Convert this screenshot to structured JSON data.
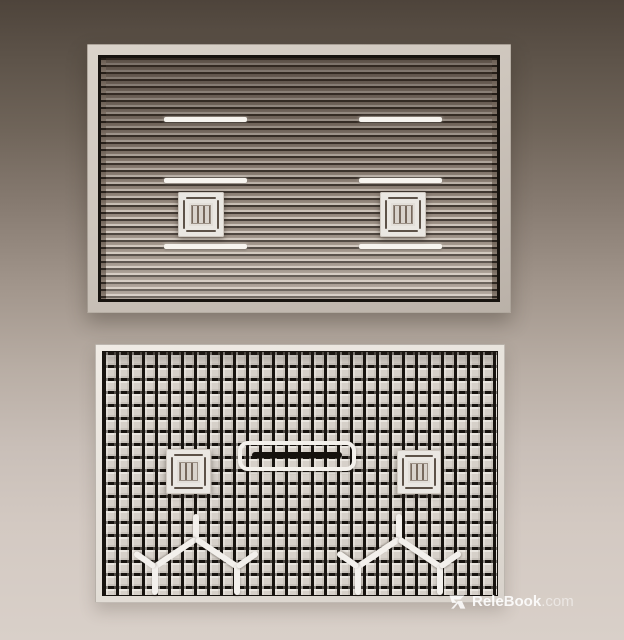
{
  "watermark": {
    "icon": "relebook-logo-icon",
    "brand": "ReleBook",
    "suffix": ".com"
  },
  "scene": {
    "background_gradient_top": "#4e443b",
    "background_gradient_bottom": "#d9d0c9",
    "panels": [
      {
        "name": "slatted-ceiling-panel",
        "frame_color": "#cdc5bc",
        "slat_face_color": "#998c81",
        "slat_gap_color": "#3a312a",
        "slat_highlight_color": "#cbc1b7",
        "light_strip_color": "#f7f4ef",
        "light_strip_count": 6,
        "cassette_vent_count": 2
      },
      {
        "name": "grid-ceiling-panel",
        "frame_color": "#e8e3dc",
        "grid_line_color": "#17130f",
        "tile_color": "#d6d0c9",
        "cassette_vent_count": 2,
        "slot_diffuser_count": 1,
        "branch_fixture_count": 2,
        "fixture_color": "#f3f0ec"
      }
    ]
  }
}
